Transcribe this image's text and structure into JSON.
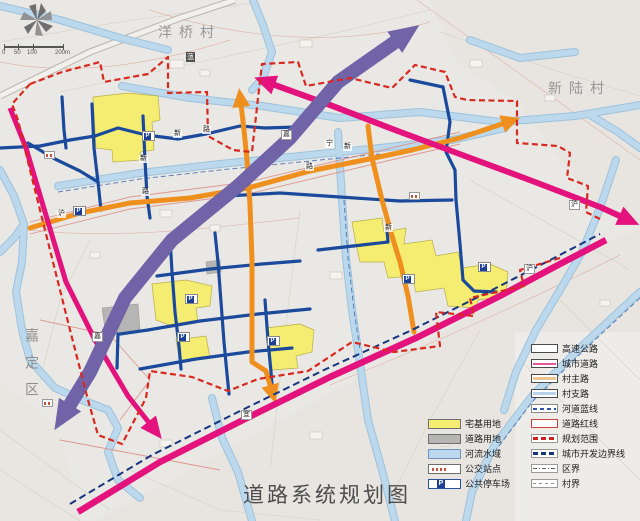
{
  "title": "道路系统规划图",
  "map": {
    "area_labels": {
      "village_top": "洋桥村",
      "village_right": "新陆村",
      "district_left": "嘉定区",
      "river_name": "蕰"
    },
    "parking_label": "P",
    "road_labels": [
      "新",
      "路",
      "新",
      "路",
      "沪",
      "路",
      "宁",
      "新",
      "新",
      "嘉",
      "沪",
      "沪",
      "宜",
      "嘉"
    ],
    "scale_ticks": [
      "0",
      "50",
      "100",
      "200m"
    ],
    "colors": {
      "expressway_corridor": "#7063a8",
      "city_road": "#e3127d",
      "village_main_road": "#ef8f1d",
      "village_branch_road": "#1b4a9c",
      "river": "#b7d5e9",
      "residential_parcel": "#f4ed71",
      "planning_boundary": "#d8281f",
      "urban_dev_boundary": "#16357f"
    }
  },
  "legend": {
    "left": [
      "宅基用地",
      "道路用地",
      "河流水域",
      "公交站点",
      "公共停车场"
    ],
    "right": [
      "高速公路",
      "城市道路",
      "村主路",
      "村支路",
      "河道蓝线",
      "道路红线",
      "规划范围",
      "城市开发边界线",
      "区界",
      "村界"
    ]
  }
}
